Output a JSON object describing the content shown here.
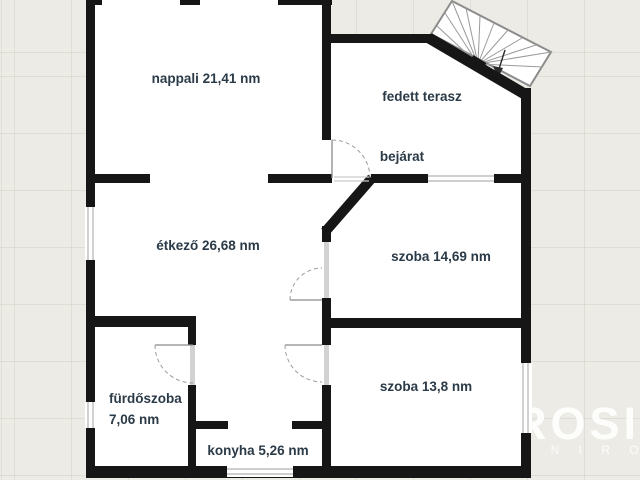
{
  "background": {
    "color": "#edebe5",
    "grid_color": "#c8c2b4"
  },
  "watermark": {
    "line1": "ROSI",
    "line2": "A N I R O D A",
    "color": "#ffffff"
  },
  "rooms": [
    {
      "id": "nappali",
      "label": "nappali 21,41 nm",
      "area_nm": 21.41
    },
    {
      "id": "fedett-terasz",
      "label": "fedett terasz"
    },
    {
      "id": "bejarat",
      "label": "bejárat"
    },
    {
      "id": "etkezo",
      "label": "étkező 26,68 nm",
      "area_nm": 26.68
    },
    {
      "id": "szoba-14",
      "label": "szoba 14,69 nm",
      "area_nm": 14.69
    },
    {
      "id": "szoba-13",
      "label": "szoba 13,8 nm",
      "area_nm": 13.8
    },
    {
      "id": "furdoszoba",
      "label_line1": "fürdőszoba",
      "label_line2": "7,06 nm",
      "area_nm": 7.06
    },
    {
      "id": "konyha",
      "label": "konyha 5,26 nm",
      "area_nm": 5.26
    }
  ],
  "colors": {
    "wall": "#161616",
    "floor": "#ffffff",
    "label_text": "#2b3a47",
    "door_arc": "#9b9b9b",
    "window_line": "#b2b2b2",
    "stair_outline": "#8c8c8c"
  }
}
